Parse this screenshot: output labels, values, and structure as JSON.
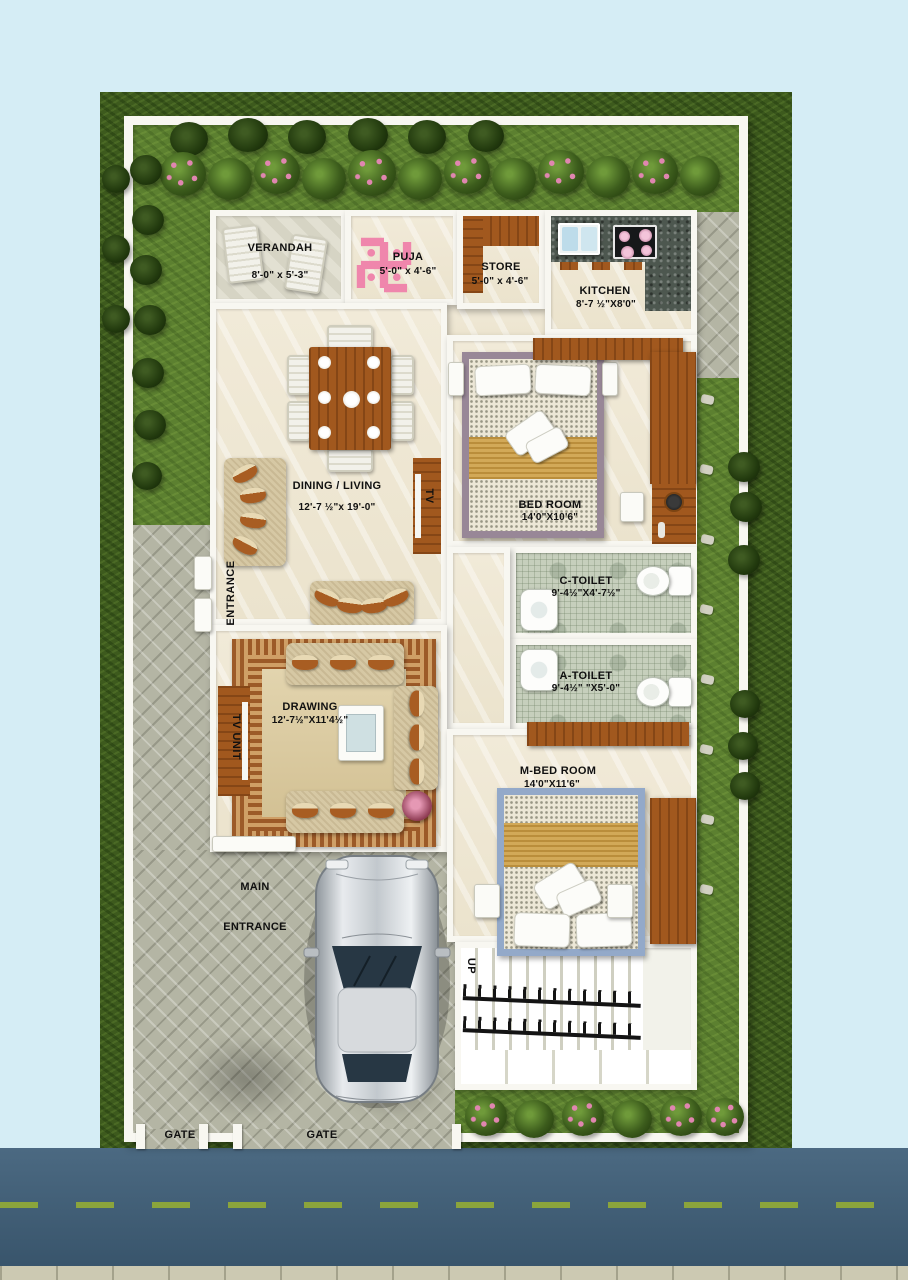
{
  "colors": {
    "bg": "#d5edf5",
    "lawn": "#5c8030",
    "hedge": "#3d5a1d",
    "wall": "#f8f7f1",
    "floor": "#f1ead8",
    "paving": "#b4b5a4",
    "wood": "#a1581e",
    "granite": "#4d574f",
    "pink": "#ef86ac",
    "road": "#40607a",
    "road_dash": "#8ba43c",
    "toilet_floor": "#c6cfbc",
    "gold": "#d2a958",
    "sofa": "#d6c8a4",
    "label": "#101010"
  },
  "rooms": [
    {
      "name": "verandah",
      "label": "VERANDAH",
      "dims": "8'-0\" x 5'-3\""
    },
    {
      "name": "puja",
      "label": "PUJA",
      "dims": "5'-0\" x 4'-6\""
    },
    {
      "name": "store",
      "label": "STORE",
      "dims": "5'-0\" x 4'-6\""
    },
    {
      "name": "kitchen",
      "label": "KITCHEN",
      "dims": "8'-7 ½\"X8'0\""
    },
    {
      "name": "dining-living",
      "label": "DINING / LIVING",
      "dims": "12'-7 ½\"x 19'-0\""
    },
    {
      "name": "bed-room",
      "label": "BED ROOM",
      "dims": "14'0\"X10'6\""
    },
    {
      "name": "c-toilet",
      "label": "C-TOILET",
      "dims": "9'-4½\"X4'-7½\""
    },
    {
      "name": "a-toilet",
      "label": "A-TOILET",
      "dims": "9'-4½\" \"X5'-0\""
    },
    {
      "name": "drawing",
      "label": "DRAWING",
      "dims": "12'-7½\"X11'4½\""
    },
    {
      "name": "m-bed-room",
      "label": "M-BED ROOM",
      "dims": "14'0\"X11'6\""
    }
  ],
  "annotations": {
    "entrance": "ENTRANCE",
    "tv_unit": "TV UNIT",
    "tv": "TV",
    "main_entrance": [
      "MAIN",
      "ENTRANCE"
    ],
    "up": "UP",
    "gates": [
      "GATE",
      "GATE"
    ]
  }
}
